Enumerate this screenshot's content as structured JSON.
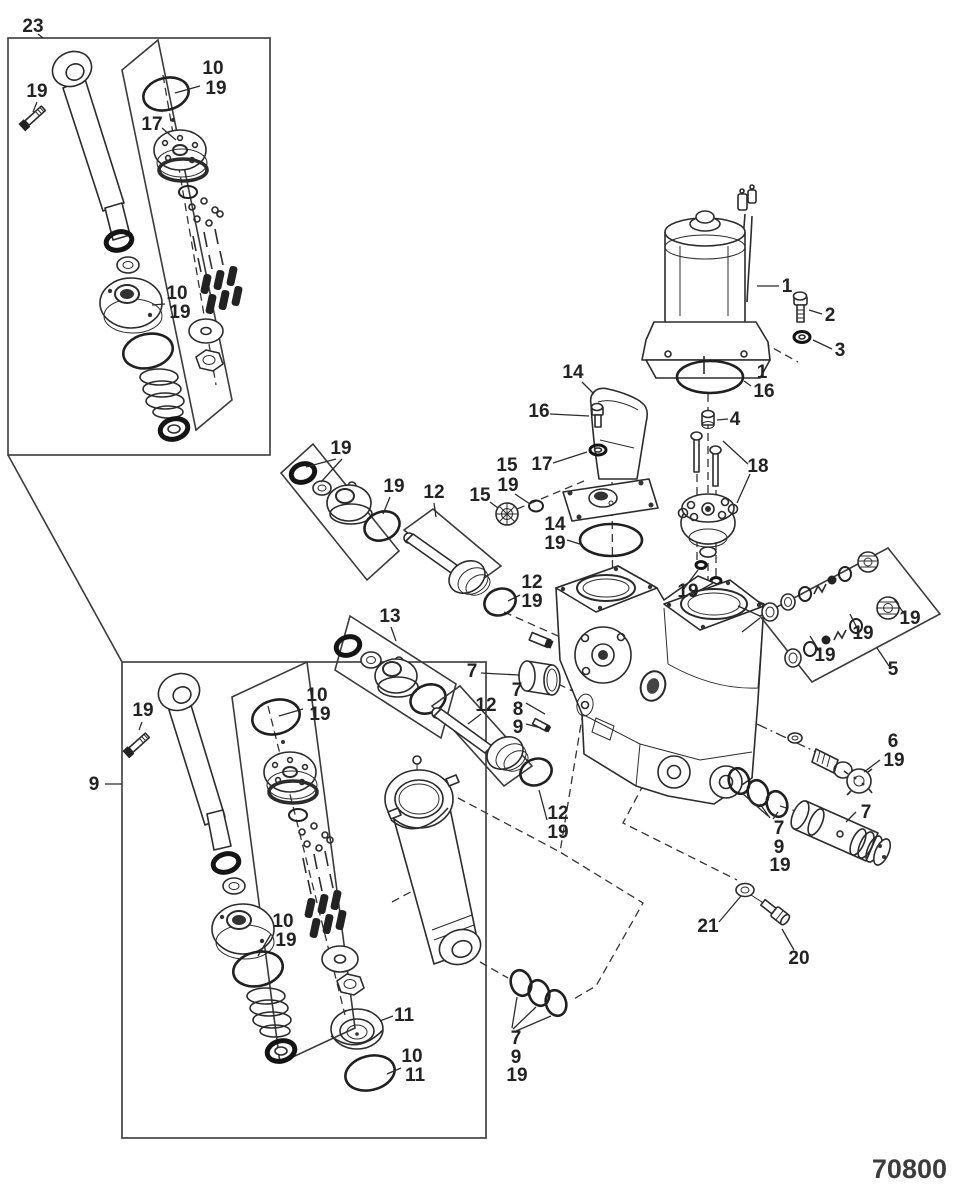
{
  "figure": {
    "drawing_number": "70800"
  },
  "callouts": [
    {
      "text": "23",
      "x": 33,
      "y": 32,
      "size": 30
    },
    {
      "text": "19",
      "x": 37,
      "y": 97
    },
    {
      "text": "10",
      "x": 213,
      "y": 74
    },
    {
      "text": "19",
      "x": 216,
      "y": 94
    },
    {
      "text": "17",
      "x": 152,
      "y": 130
    },
    {
      "text": "10",
      "x": 177,
      "y": 299
    },
    {
      "text": "19",
      "x": 180,
      "y": 318
    },
    {
      "text": "9",
      "x": 94,
      "y": 790
    },
    {
      "text": "19",
      "x": 143,
      "y": 716
    },
    {
      "text": "10",
      "x": 317,
      "y": 701
    },
    {
      "text": "19",
      "x": 320,
      "y": 720
    },
    {
      "text": "10",
      "x": 283,
      "y": 927
    },
    {
      "text": "19",
      "x": 286,
      "y": 946
    },
    {
      "text": "11",
      "x": 404,
      "y": 1021
    },
    {
      "text": "10",
      "x": 412,
      "y": 1062
    },
    {
      "text": "11",
      "x": 415,
      "y": 1081
    },
    {
      "text": "19",
      "x": 341,
      "y": 454
    },
    {
      "text": "19",
      "x": 394,
      "y": 492
    },
    {
      "text": "12",
      "x": 434,
      "y": 498
    },
    {
      "text": "12",
      "x": 532,
      "y": 588
    },
    {
      "text": "19",
      "x": 532,
      "y": 607
    },
    {
      "text": "13",
      "x": 390,
      "y": 622
    },
    {
      "text": "7",
      "x": 472,
      "y": 677
    },
    {
      "text": "7",
      "x": 517,
      "y": 696
    },
    {
      "text": "8",
      "x": 518,
      "y": 715
    },
    {
      "text": "9",
      "x": 518,
      "y": 733
    },
    {
      "text": "12",
      "x": 486,
      "y": 711
    },
    {
      "text": "12",
      "x": 558,
      "y": 819
    },
    {
      "text": "19",
      "x": 558,
      "y": 838
    },
    {
      "text": "14",
      "x": 573,
      "y": 378
    },
    {
      "text": "16",
      "x": 539,
      "y": 417
    },
    {
      "text": "17",
      "x": 542,
      "y": 470
    },
    {
      "text": "15",
      "x": 507,
      "y": 471
    },
    {
      "text": "19",
      "x": 508,
      "y": 491
    },
    {
      "text": "15",
      "x": 480,
      "y": 501
    },
    {
      "text": "14",
      "x": 555,
      "y": 530
    },
    {
      "text": "19",
      "x": 555,
      "y": 549
    },
    {
      "text": "1",
      "x": 787,
      "y": 292
    },
    {
      "text": "2",
      "x": 830,
      "y": 321
    },
    {
      "text": "3",
      "x": 840,
      "y": 356
    },
    {
      "text": "1",
      "x": 762,
      "y": 378
    },
    {
      "text": "16",
      "x": 764,
      "y": 397
    },
    {
      "text": "4",
      "x": 735,
      "y": 425
    },
    {
      "text": "18",
      "x": 758,
      "y": 472
    },
    {
      "text": "19",
      "x": 688,
      "y": 597
    },
    {
      "text": "19",
      "x": 825,
      "y": 661
    },
    {
      "text": "19",
      "x": 863,
      "y": 639
    },
    {
      "text": "19",
      "x": 910,
      "y": 624
    },
    {
      "text": "5",
      "x": 893,
      "y": 675
    },
    {
      "text": "6",
      "x": 893,
      "y": 747
    },
    {
      "text": "19",
      "x": 894,
      "y": 766
    },
    {
      "text": "7",
      "x": 866,
      "y": 818
    },
    {
      "text": "7",
      "x": 779,
      "y": 834
    },
    {
      "text": "9",
      "x": 779,
      "y": 853
    },
    {
      "text": "19",
      "x": 780,
      "y": 871
    },
    {
      "text": "21",
      "x": 708,
      "y": 932
    },
    {
      "text": "20",
      "x": 799,
      "y": 964
    },
    {
      "text": "7",
      "x": 516,
      "y": 1044
    },
    {
      "text": "9",
      "x": 516,
      "y": 1063
    },
    {
      "text": "19",
      "x": 517,
      "y": 1081
    }
  ]
}
